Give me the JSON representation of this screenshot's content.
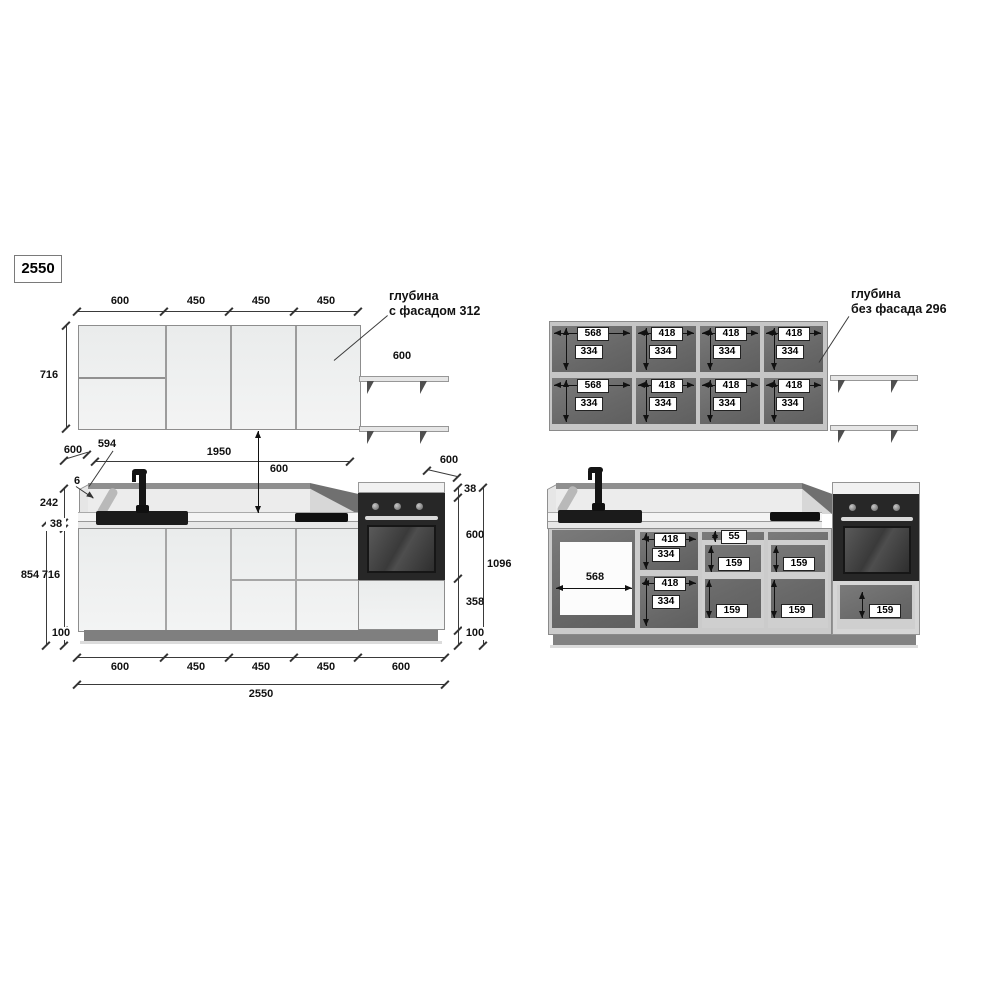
{
  "colors": {
    "interior_gray": "#6d6d6d",
    "carcass_gray": "#cbcbcb",
    "door_white": "#eff1f1",
    "oven_black": "#272727",
    "plinth_gray": "#7f7f7f",
    "dim_line": "#333333"
  },
  "total_box": "2550",
  "wall_closed": {
    "widths": [
      "600",
      "450",
      "450",
      "450"
    ],
    "height": "716",
    "shelf_depth": "600",
    "note_line1": "глубина",
    "note_line2": "с фасадом 312"
  },
  "wall_open": {
    "note_line1": "глубина",
    "note_line2": "без фасада 296",
    "sections": [
      {
        "top_w": "568",
        "top_h": "334",
        "bot_w": "568",
        "bot_h": "334"
      },
      {
        "top_w": "418",
        "top_h": "334",
        "bot_w": "418",
        "bot_h": "334"
      },
      {
        "top_w": "418",
        "top_h": "334",
        "bot_w": "418",
        "bot_h": "334"
      },
      {
        "top_w": "418",
        "top_h": "334",
        "bot_w": "418",
        "bot_h": "334"
      }
    ]
  },
  "base_closed": {
    "depth_left": "600",
    "overhang": "594",
    "run_length": "1950",
    "splash_to_wall_cab": "600",
    "depth_right": "600",
    "panel_thickness": "6",
    "splash_height": "242",
    "worktop_thickness": "38",
    "door_height": "716",
    "plinth_height": "100",
    "left_total": "854",
    "right_worktop": "38",
    "oven_height": "600",
    "oven_drawer_height": "358",
    "right_plinth": "100",
    "right_total": "1096",
    "bottom_widths": [
      "600",
      "450",
      "450",
      "450",
      "600"
    ],
    "total_width": "2550"
  },
  "base_open": {
    "sink_width": "568",
    "cabinet2": {
      "top_w": "418",
      "top_h": "334",
      "bot_w": "418",
      "bot_h": "334"
    },
    "stack3": {
      "d1": "55",
      "d2": "159",
      "d3": "159"
    },
    "stack4": {
      "d2": "159",
      "d3": "159"
    },
    "oven_drawer": "159"
  }
}
